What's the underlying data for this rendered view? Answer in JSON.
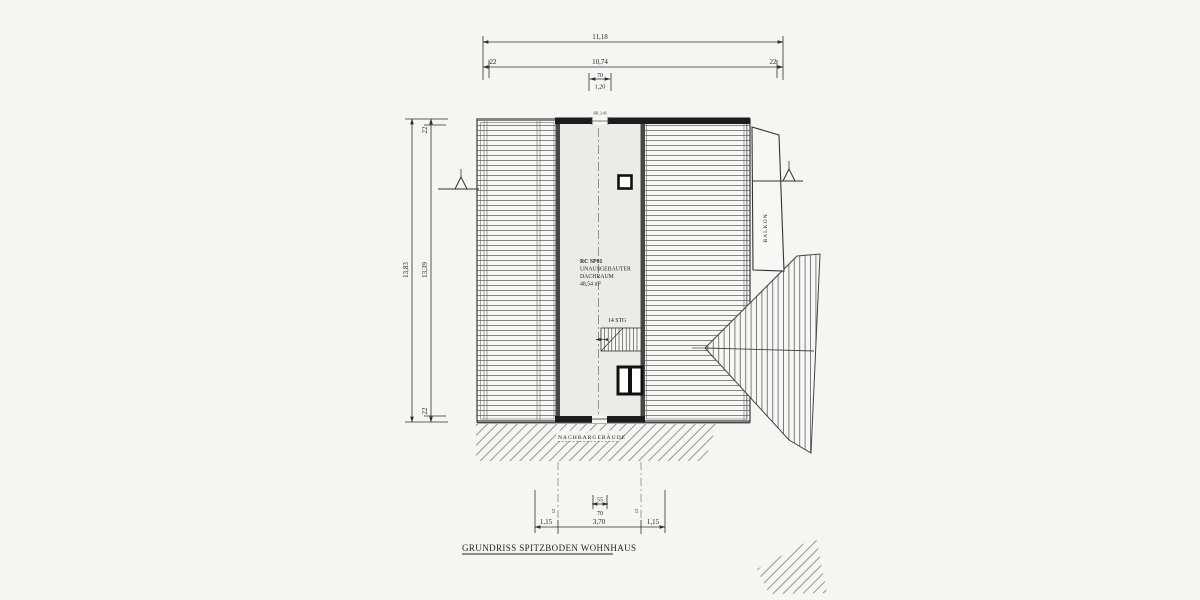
{
  "drawing": {
    "title": "GRUNDRISS SPITZBODEN WOHNHAUS",
    "room": {
      "code": "RC SP01",
      "name_line1": "UNAUSGEBAUTER",
      "name_line2": "DACHRAUM",
      "area": "48,54 m²"
    },
    "labels": {
      "stairs": "14 STG",
      "balcony": "BALKON",
      "neighbor": "NACHBARGEBÄUDE",
      "top_window": "BR 3.46"
    },
    "dims": {
      "top": {
        "overall": "11,18",
        "left": "22",
        "middle": "10,74",
        "right": "22",
        "win_w": "70",
        "win_h": "1,20"
      },
      "left": {
        "overall": "13,83",
        "top": "22",
        "middle": "13,39",
        "bottom": "22"
      },
      "bottom": {
        "upper": "55",
        "lower": "70",
        "left": "1,15",
        "middle": "3,70",
        "right": "1,15",
        "wall_left": "12",
        "wall_right": "12"
      }
    },
    "colors": {
      "ink": "#2f2f2f",
      "paper": "#f5f5f3",
      "wall": "#1c1c1c",
      "room_fill": "#ebebe8"
    }
  }
}
